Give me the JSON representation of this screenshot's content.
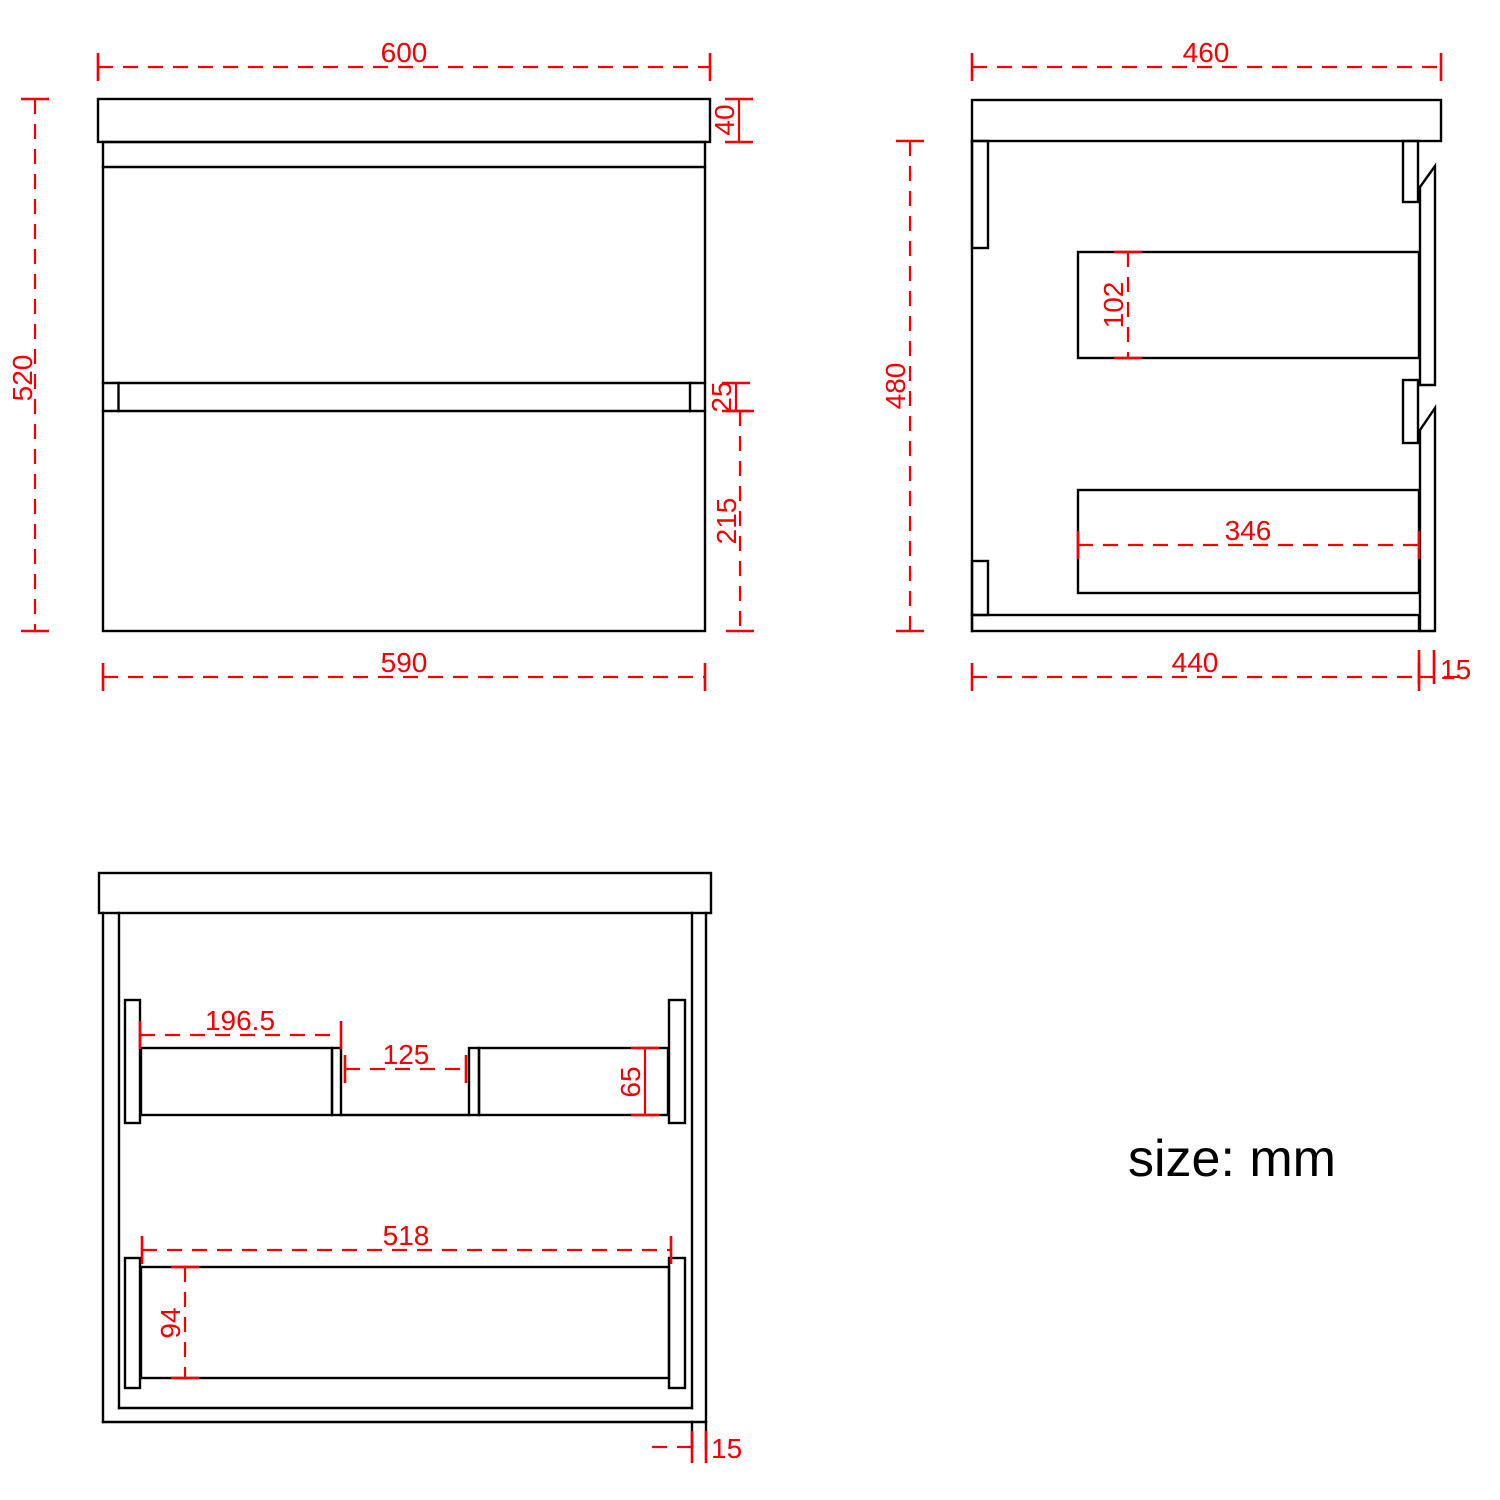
{
  "note": "size: mm",
  "colors": {
    "dimension_red": "#f40000",
    "line_black": "#000000",
    "background": "#ffffff"
  },
  "front": {
    "width_top": "600",
    "counter_thickness": "40",
    "height_total": "520",
    "drawer_gap": "25",
    "drawer_bottom_height": "215",
    "width_body": "590"
  },
  "side": {
    "depth_top": "460",
    "height_body": "480",
    "drawer_box_height": "102",
    "drawer_box_depth": "346",
    "depth_body": "440",
    "front_panel_thickness": "15"
  },
  "internal": {
    "left_rail_length": "196.5",
    "rail_gap": "125",
    "rail_height": "65",
    "bottom_rail_length": "518",
    "bottom_rail_height": "94",
    "side_panel_thickness": "15"
  }
}
